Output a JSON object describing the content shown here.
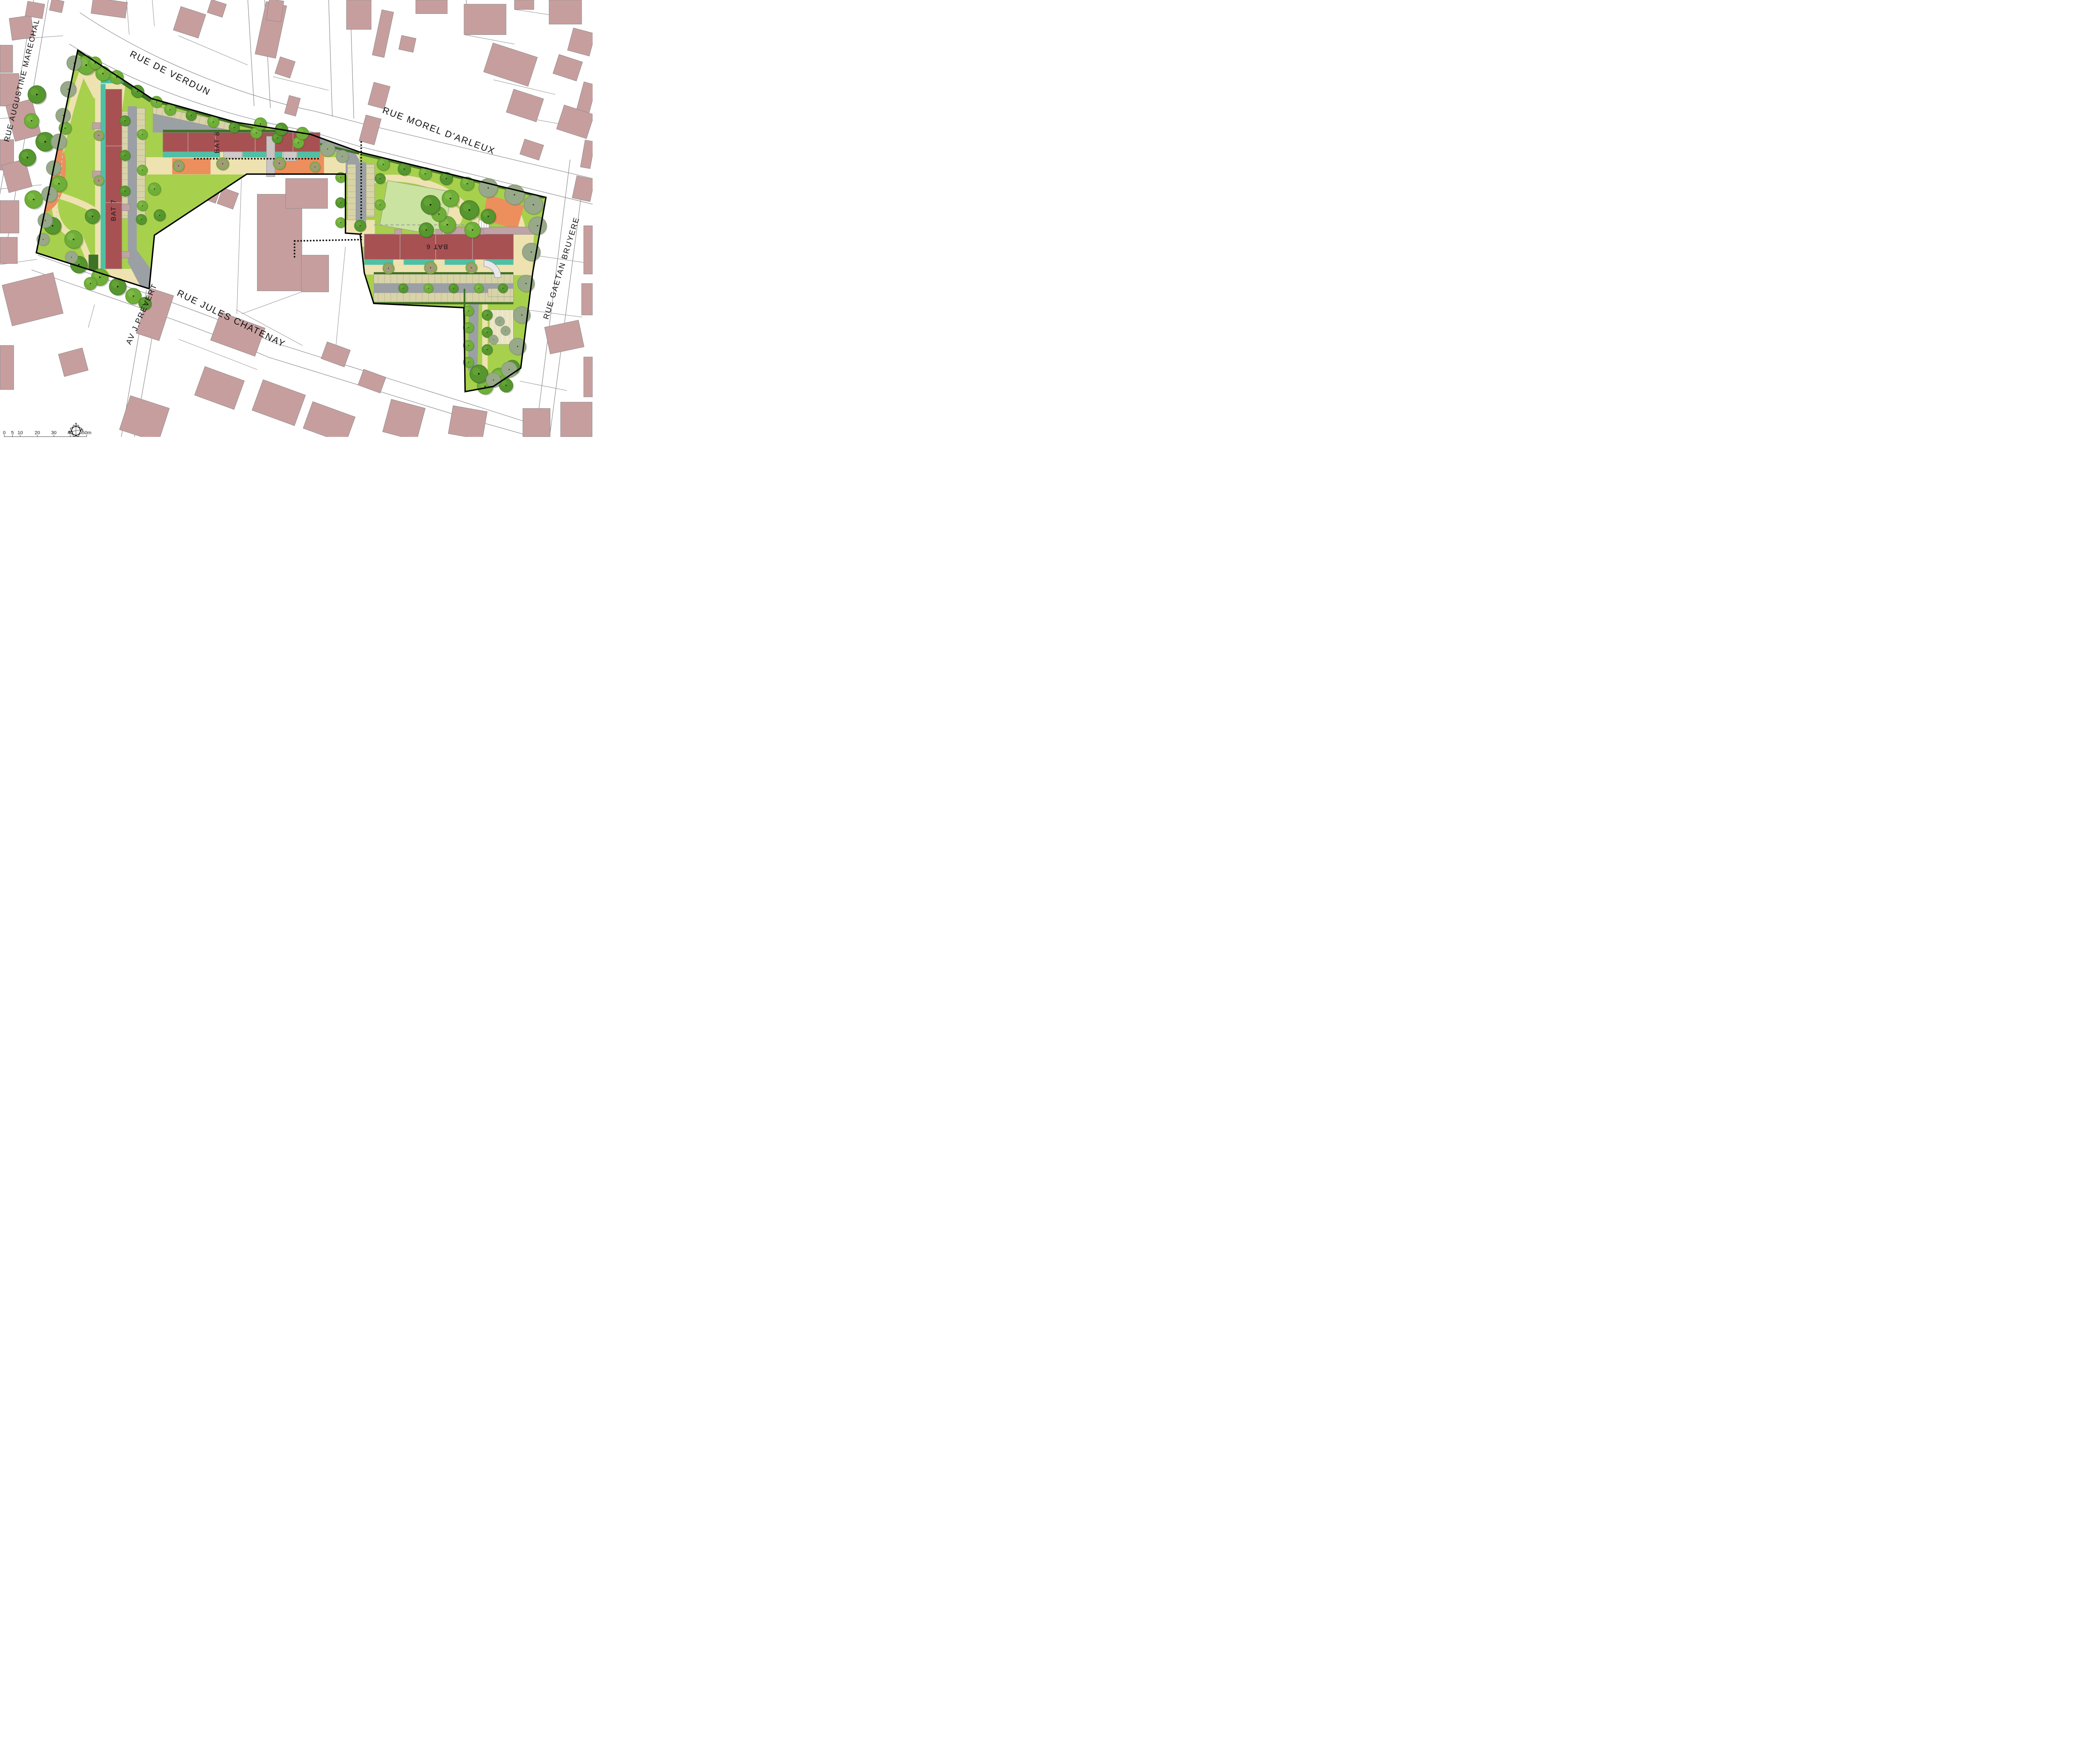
{
  "streets": {
    "rue_augustine_marechal": "RUE AUGUSTINE MARECHAL",
    "rue_de_verdun": "RUE DE VERDUN",
    "rue_morel_darleux": "RUE MOREL D'ARLEUX",
    "rue_jules_chatenay": "RUE JULES CHATENAY",
    "av_j_prevert": "AV J.PREVERT",
    "rue_gaetan_bruyere": "RUE GAETAN BRUYERE"
  },
  "buildings": {
    "bat7": "BAT 7",
    "bat8": "BAT 8",
    "bat6": "BAT 6"
  },
  "compass": {
    "north": "N",
    "east": "E",
    "south": "S",
    "west": "O"
  },
  "scale_bar": {
    "ticks": [
      "0",
      "5",
      "10",
      "20",
      "30",
      "40",
      "50m"
    ]
  },
  "palette": {
    "background": "#ffffff",
    "parcel_line": "#8f8f8f",
    "existing_building": "#c79e9e",
    "site_lawn": "#a7d04c",
    "field_lawn": "#cbe3a0",
    "tree_green": "#6fae38",
    "tree_dark": "#55962e",
    "shrub_sage": "#97a988",
    "hedge_dark": "#3e7226",
    "path_beige": "#eee2b0",
    "stall_beige": "#d9d4a8",
    "road_grey": "#9ba0a4",
    "play_orange": "#ec8f5d",
    "planted_teal": "#4fc0a5",
    "project_building_red": "#a85153",
    "access_deck_pink": "#c0a3a6",
    "site_boundary": "#000000",
    "label_text": "#111111"
  }
}
